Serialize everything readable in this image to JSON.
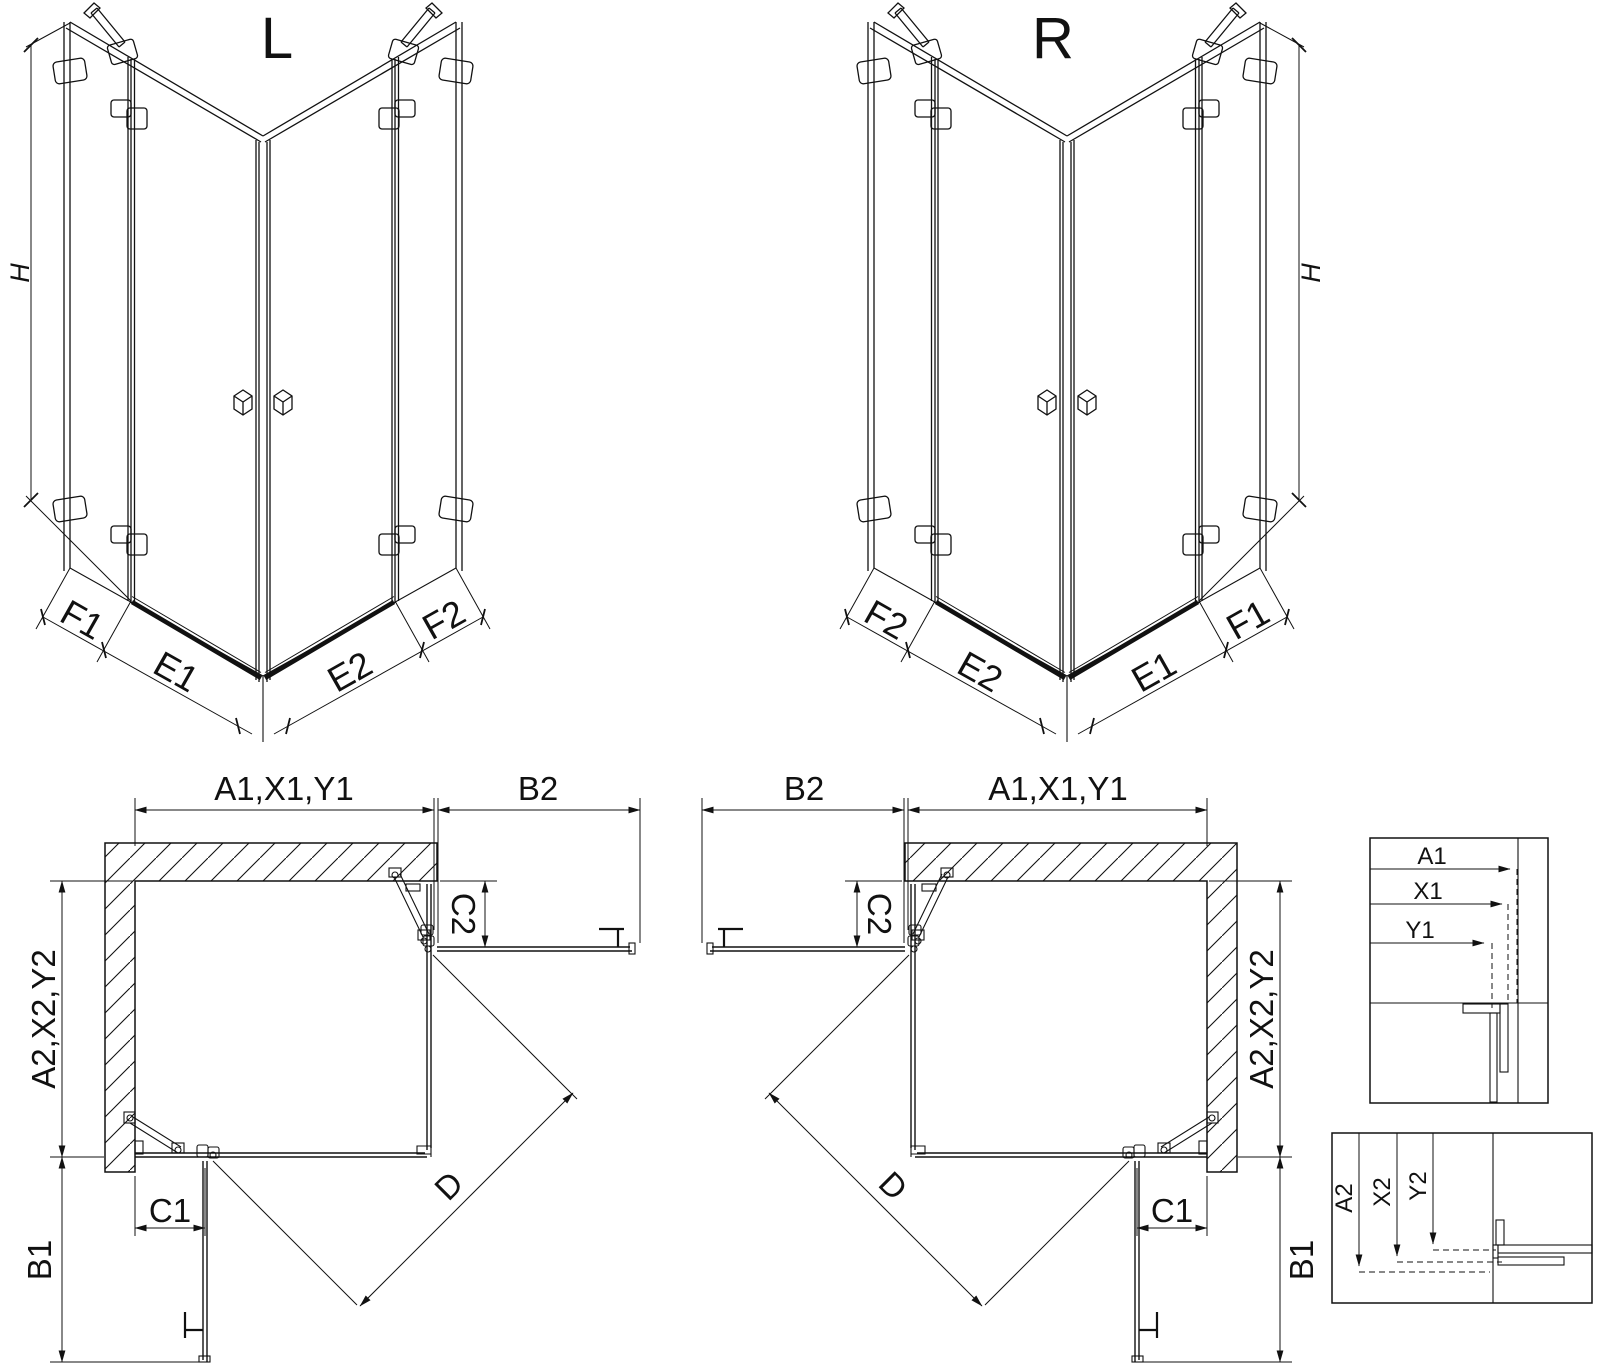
{
  "colors": {
    "line": "#111111",
    "background": "#ffffff"
  },
  "titles": {
    "left_view": "L",
    "right_view": "R"
  },
  "view3d": {
    "h": "H",
    "f1": "F1",
    "e1": "E1",
    "e2": "E2",
    "f2": "F2"
  },
  "plan": {
    "a1": "A1,X1,Y1",
    "b2": "B2",
    "c2": "C2",
    "a2": "A2,X2,Y2",
    "b1": "B1",
    "c1": "C1",
    "d": "D"
  },
  "detail_top": {
    "a1": "A1",
    "x1": "X1",
    "y1": "Y1"
  },
  "detail_bottom": {
    "a2": "A2",
    "x2": "X2",
    "y2": "Y2"
  }
}
